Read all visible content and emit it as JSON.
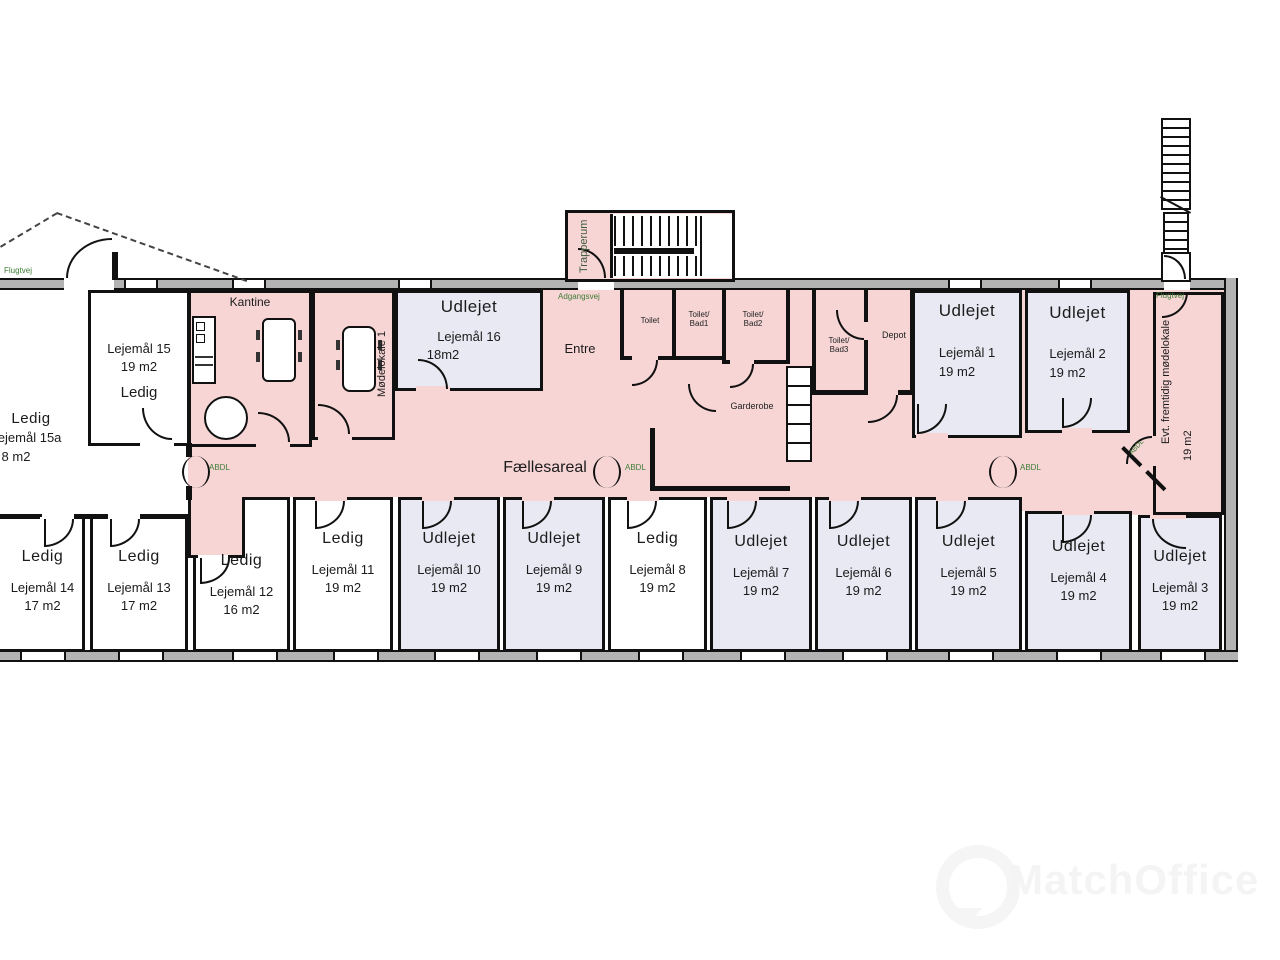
{
  "areas": {
    "faellesareal": "Fællesareal",
    "kantine": "Kantine",
    "entre": "Entre",
    "trapperum": "Trapperum",
    "moedelokale": "Mødelokale 1",
    "garderobe": "Garderobe",
    "toilet": "Toilet",
    "toilet_bad1": "Toilet/ Bad1",
    "toilet_bad2": "Toilet/ Bad2",
    "toilet_bad3": "Toilet/ Bad3",
    "depot": "Depot",
    "future_room_name": "Evt. fremtidig mødelokale",
    "future_room_area": "19 m2"
  },
  "safety": {
    "flugtvej_left": "Flugtvej",
    "flugtvej_right": "Flugtvej",
    "adgangsvej": "Adgangsvej",
    "abdl_left": "ABDL",
    "abdl_center": "ABDL",
    "abdl_right": "ABDL",
    "abdl_diagonal": "ABDL"
  },
  "top_rooms": {
    "r15a": {
      "status": "Ledig",
      "name": "Lejemål 15a",
      "area": "8 m2"
    },
    "r15": {
      "name": "Lejemål 15",
      "area": "19 m2",
      "status": "Ledig"
    },
    "r16": {
      "status": "Udlejet",
      "name": "Lejemål 16",
      "area": "18m2"
    },
    "r1": {
      "status": "Udlejet",
      "name": "Lejemål 1",
      "area": "19 m2"
    },
    "r2": {
      "status": "Udlejet",
      "name": "Lejemål 2",
      "area": "19 m2"
    }
  },
  "bottom_rooms": [
    {
      "status": "Ledig",
      "name": "Lejemål 14",
      "area": "17 m2"
    },
    {
      "status": "Ledig",
      "name": "Lejemål 13",
      "area": "17 m2"
    },
    {
      "status": "Ledig",
      "name": "Lejemål 12",
      "area": "16 m2"
    },
    {
      "status": "Ledig",
      "name": "Lejemål 11",
      "area": "19 m2"
    },
    {
      "status": "Udlejet",
      "name": "Lejemål 10",
      "area": "19 m2"
    },
    {
      "status": "Udlejet",
      "name": "Lejemål 9",
      "area": "19 m2"
    },
    {
      "status": "Ledig",
      "name": "Lejemål 8",
      "area": "19 m2"
    },
    {
      "status": "Udlejet",
      "name": "Lejemål 7",
      "area": "19 m2"
    },
    {
      "status": "Udlejet",
      "name": "Lejemål 6",
      "area": "19 m2"
    },
    {
      "status": "Udlejet",
      "name": "Lejemål 5",
      "area": "19 m2"
    },
    {
      "status": "Udlejet",
      "name": "Lejemål 4",
      "area": "19 m2"
    },
    {
      "status": "Udlejet",
      "name": "Lejemål 3",
      "area": "19 m2"
    }
  ],
  "watermark": {
    "brand": "MatchOffice"
  }
}
